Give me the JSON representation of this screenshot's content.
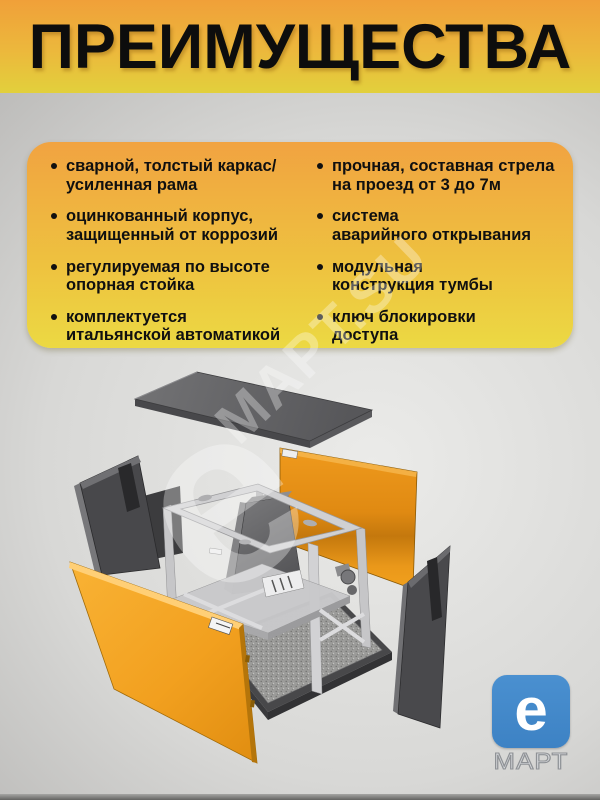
{
  "page": {
    "title": "ПРЕИМУЩЕСТВА"
  },
  "advantages": {
    "left": [
      "сварной, толстый каркас/\nусиленная рама",
      "оцинкованный корпус,\nзащищенный от коррозий",
      "регулируемая по высоте\nопорная стойка",
      "комплектуется\nитальянской автоматикой"
    ],
    "right": [
      "прочная, составная стрела\nна проезд от 3 до 7м",
      "система\nаварийного открывания",
      "модульная\nконструкция тумбы",
      "ключ блокировки\nдоступа"
    ]
  },
  "watermark": {
    "big_letter": "е",
    "text": "МАРТ.SU"
  },
  "logo": {
    "letter": "е",
    "caption": "МАРТ"
  },
  "diagram": {
    "description": "exploded view of a barrier-gate cabinet",
    "parts": [
      "top-cover",
      "side-panel-left",
      "front-panel",
      "frame-with-drive",
      "rear-panel",
      "side-panel-right",
      "base-plate"
    ]
  },
  "colors": {
    "header_orange": "#F0A039",
    "header_yellow": "#E2D03C",
    "card_top": "#F1A341",
    "card_bottom": "#ECD943",
    "panel_orange": "#F2A01F",
    "panel_dark": "#4A4A4D",
    "frame_gray": "#C7C7C9",
    "logo_blue": "#4187C8"
  }
}
